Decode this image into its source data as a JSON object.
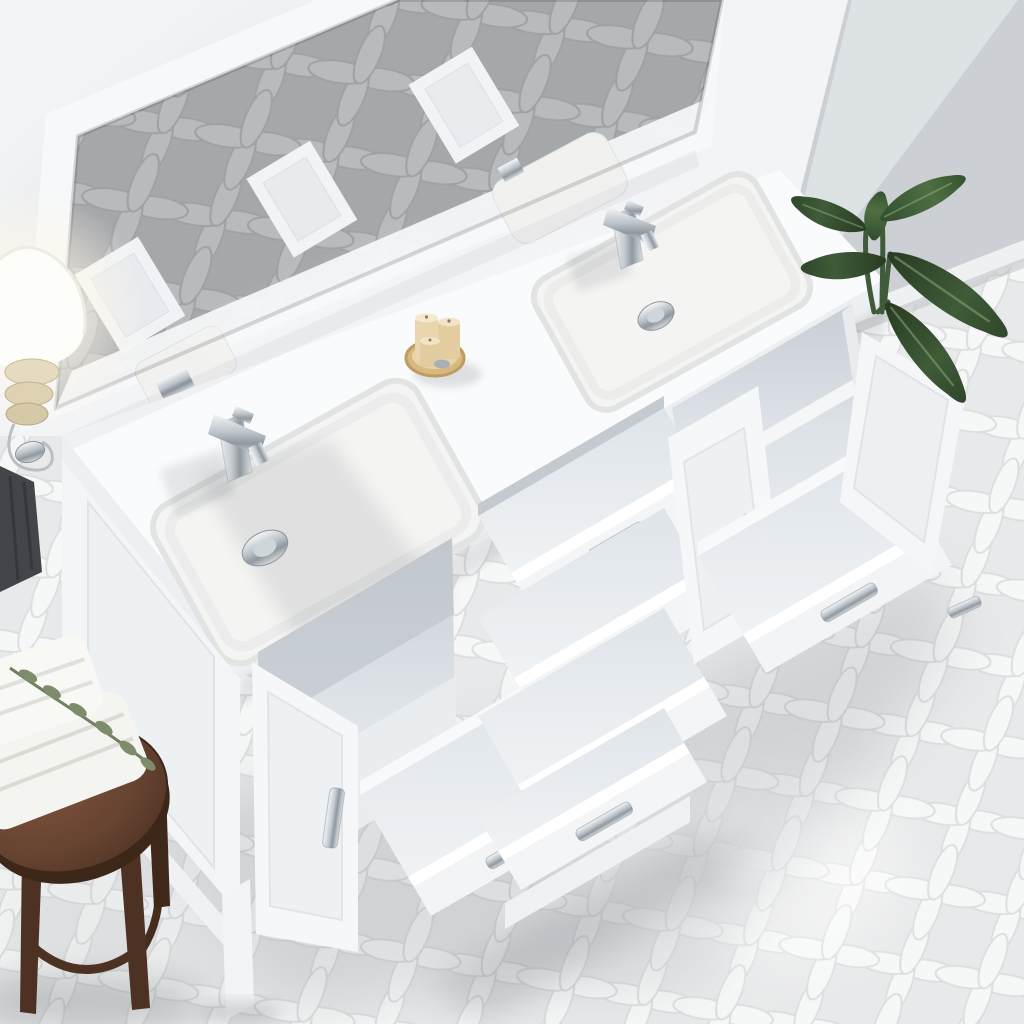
{
  "meta": {
    "description": "Top-down product photo of a white double-sink bathroom vanity with mirror, open drawers and doors, on patterned gray tile floor",
    "text_content": "none"
  },
  "palette": {
    "wall_left": "#f3f4f6",
    "wall_right": "#cbd0d4",
    "wall_sunlit": "#dde2e4",
    "baseboard": "#eef0f1",
    "floor_base": "#e8e9ea",
    "floor_motif": "#f6f7f7",
    "mirror_glass_base": "#a4a7aa",
    "frame_white": "#f6f8f9",
    "counter_top": "#fafbfc",
    "counter_edge": "#edf0f2",
    "cabinet_white": "#f3f5f7",
    "cabinet_interior": "#dde2e7",
    "drawer_interior": "#edf0f3",
    "chrome": "#aeb6bc",
    "candle_wax": "#e9d6ad",
    "candle_tray": "#d8b77c",
    "plant_green": "#3f5c35",
    "stool_seat": "#6b4430",
    "stool_leg": "#4a2d1e",
    "towel_white": "#f4f4f1",
    "towel_dark": "#3f4347",
    "lamp_ring": "#e6dbbf"
  },
  "scene": {
    "objects": [
      {
        "label": "framed-mirror",
        "count": 1
      },
      {
        "label": "double-sink-vanity",
        "count": 1
      },
      {
        "label": "undermount-sink",
        "count": 2
      },
      {
        "label": "chrome-faucet",
        "count": 2
      },
      {
        "label": "open-drawer",
        "count": 6
      },
      {
        "label": "open-door",
        "count": 3
      },
      {
        "label": "candle-tray",
        "candles": 3
      },
      {
        "label": "potted-plant-leaves",
        "count": 1
      },
      {
        "label": "wooden-stool",
        "count": 1
      },
      {
        "label": "folded-towel",
        "count": 2
      },
      {
        "label": "hanging-dark-towel",
        "count": 1
      },
      {
        "label": "wall-lamp",
        "count": 1
      },
      {
        "label": "patterned-tile-floor",
        "count": 1
      }
    ]
  }
}
